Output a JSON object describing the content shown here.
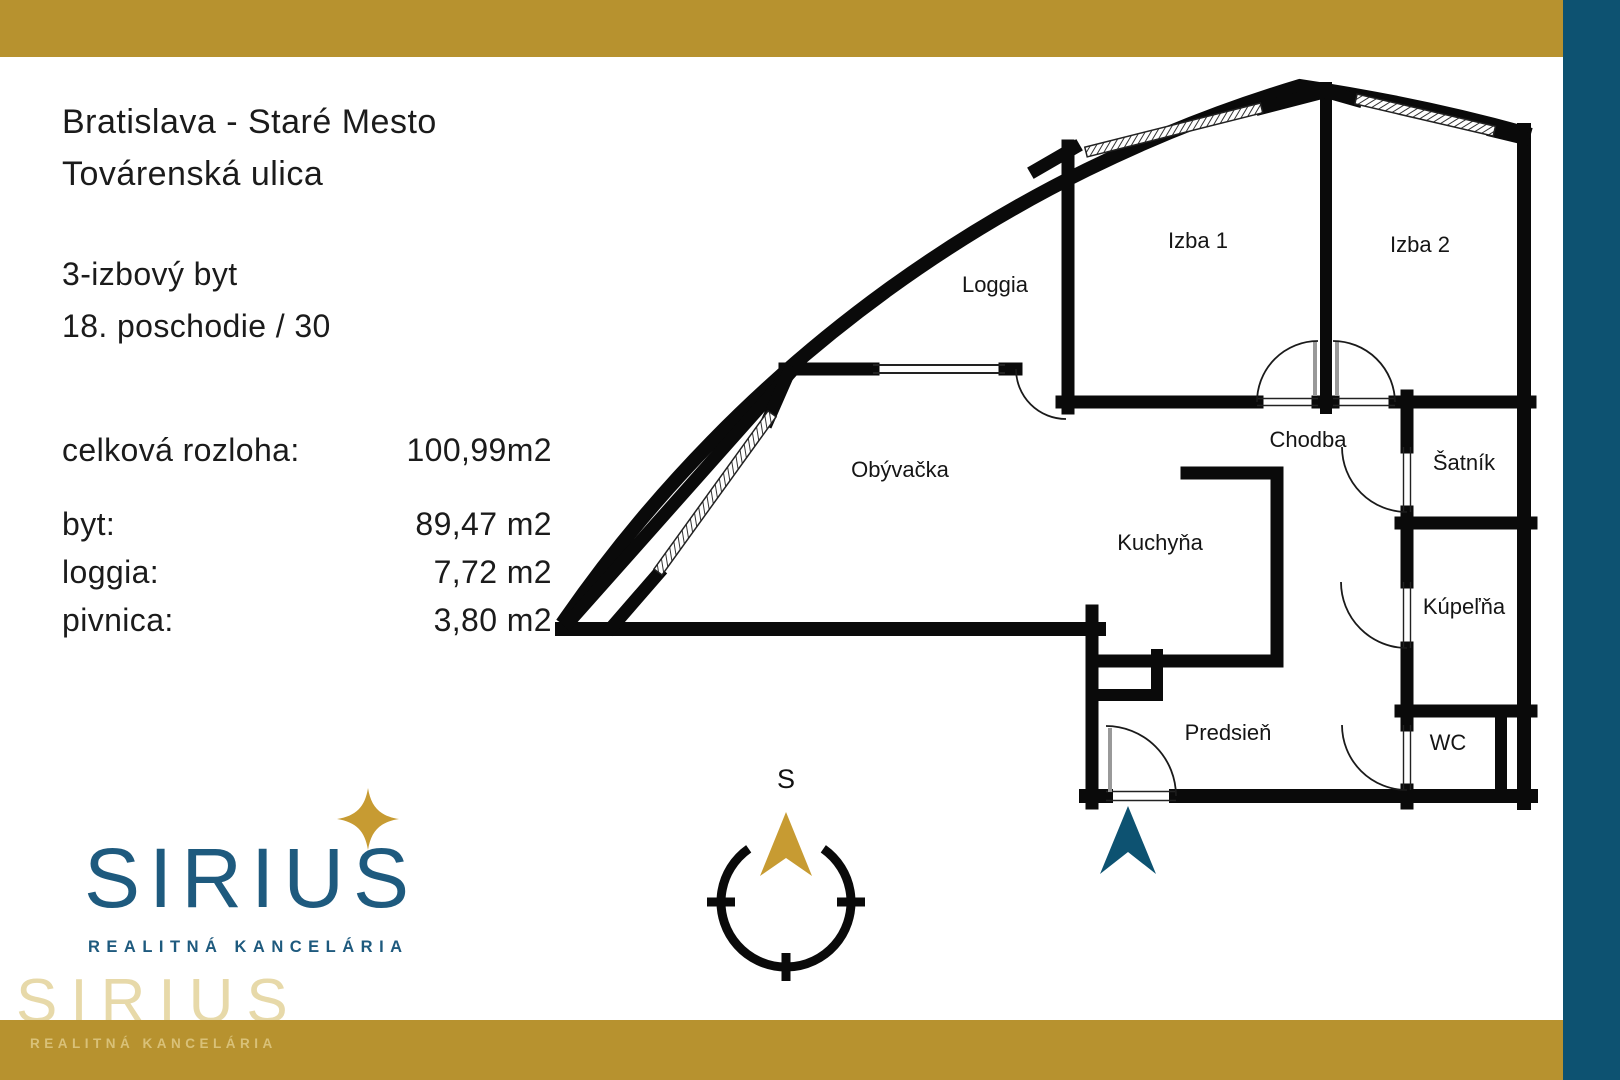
{
  "theme": {
    "gold": "#b7922f",
    "blue": "#0d5271",
    "logo_blue": "#1e5a7e",
    "star_gold": "#c79b32",
    "wall_black": "#0a0a0a"
  },
  "header": {
    "location_line1": "Bratislava - Staré Mesto",
    "location_line2": "Továrenská ulica",
    "unit_line1": "3-izbový byt",
    "unit_line2": "18. poschodie / 30"
  },
  "areas": {
    "total_label": "celková rozloha:",
    "total_value": "100,99m2",
    "rows": [
      {
        "label": "byt:",
        "value": "89,47 m2"
      },
      {
        "label": "loggia:",
        "value": "7,72 m2"
      },
      {
        "label": "pivnica:",
        "value": "3,80 m2"
      }
    ]
  },
  "plan": {
    "rooms": {
      "loggia": "Loggia",
      "izba1": "Izba 1",
      "izba2": "Izba 2",
      "obyvacka": "Obývačka",
      "chodba": "Chodba",
      "satnik": "Šatník",
      "kuchyna": "Kuchyňa",
      "kupelna": "Kúpeľňa",
      "predsien": "Predsieň",
      "wc": "WC"
    },
    "compass_label": "S"
  },
  "logo": {
    "name": "SIRIUS",
    "tagline": "REALITNÁ KANCELÁRIA"
  },
  "watermark": {
    "big": "SIRIUS",
    "small": "REALITNÁ KANCELÁRIA"
  }
}
